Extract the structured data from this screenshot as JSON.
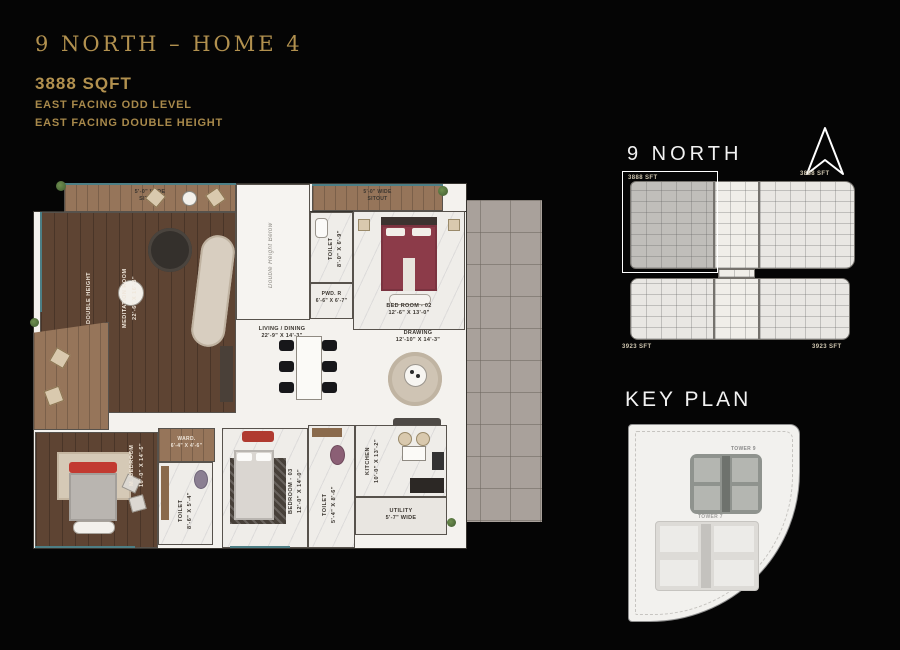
{
  "header": {
    "title": "9 NORTH – HOME 4",
    "sqft": "3888 SQFT",
    "facing1": "EAST FACING ODD LEVEL",
    "facing2": "EAST FACING DOUBLE HEIGHT"
  },
  "plan": {
    "sitout_tl": {
      "name": "5'-0\" WIDE",
      "dims": "SITOUT"
    },
    "sitout_tr": {
      "name": "5'-0\" WIDE",
      "dims": "SITOUT"
    },
    "double_height": "DOUBLE HEIGHT",
    "meditation": {
      "name": "MEDITATION ROOM",
      "dims": "22'-6\" X 16'-3\""
    },
    "dh_below": "Double Height Below",
    "toilet_top": {
      "name": "TOILET",
      "dims": "8'-0\" X 6'-9\""
    },
    "pwd": {
      "name": "PWD. R",
      "dims": "6'-6\" X 6'-7\""
    },
    "bedroom2": {
      "name": "BED ROOM - 02",
      "dims": "12'-6\" X 13'-0\""
    },
    "living": {
      "name": "LIVING / DINING",
      "dims": "22'-9\" X 14'-3\""
    },
    "drawing": {
      "name": "DRAWING",
      "dims": "12'-10\" X 14'-3\""
    },
    "master": {
      "name": "M. BEDROOM",
      "dims": "16'-0\" X 14'-6\""
    },
    "ward": {
      "name": "WARD.",
      "dims": "6'-4\" X 4'-6\""
    },
    "toilet_m": {
      "name": "TOILET",
      "dims": "8'-6\" X 5'-4\""
    },
    "bedroom3": {
      "name": "BEDROOM - 03",
      "dims": "12'-0\" X 14'-0\""
    },
    "toilet3": {
      "name": "TOILET",
      "dims": "5'-4\" X 8'-6\""
    },
    "kitchen": {
      "name": "KITCHEN",
      "dims": "10'-0\" X 13'-2\""
    },
    "utility": {
      "name": "UTILITY",
      "dims": "5'-7\" WIDE"
    }
  },
  "north_panel": {
    "title": "9 NORTH",
    "compass_icon": "north-arrow",
    "upper_left": "3888 SFT",
    "upper_right": "3888 SFT",
    "lower_left": "3923 SFT",
    "lower_right": "3923 SFT"
  },
  "key_plan": {
    "title": "KEY PLAN",
    "tower_selected": "TOWER 9",
    "tower_other": "TOWER 7"
  },
  "colors": {
    "gold": "#b2914f",
    "background": "#050505",
    "wood_dark": "#5e4433",
    "wood_light": "#96755a",
    "marble": "#efede9",
    "tile": "#a9a19b",
    "maroon": "#8c3b49",
    "accent_red": "#c0392b",
    "window_teal": "#4d7f86"
  }
}
